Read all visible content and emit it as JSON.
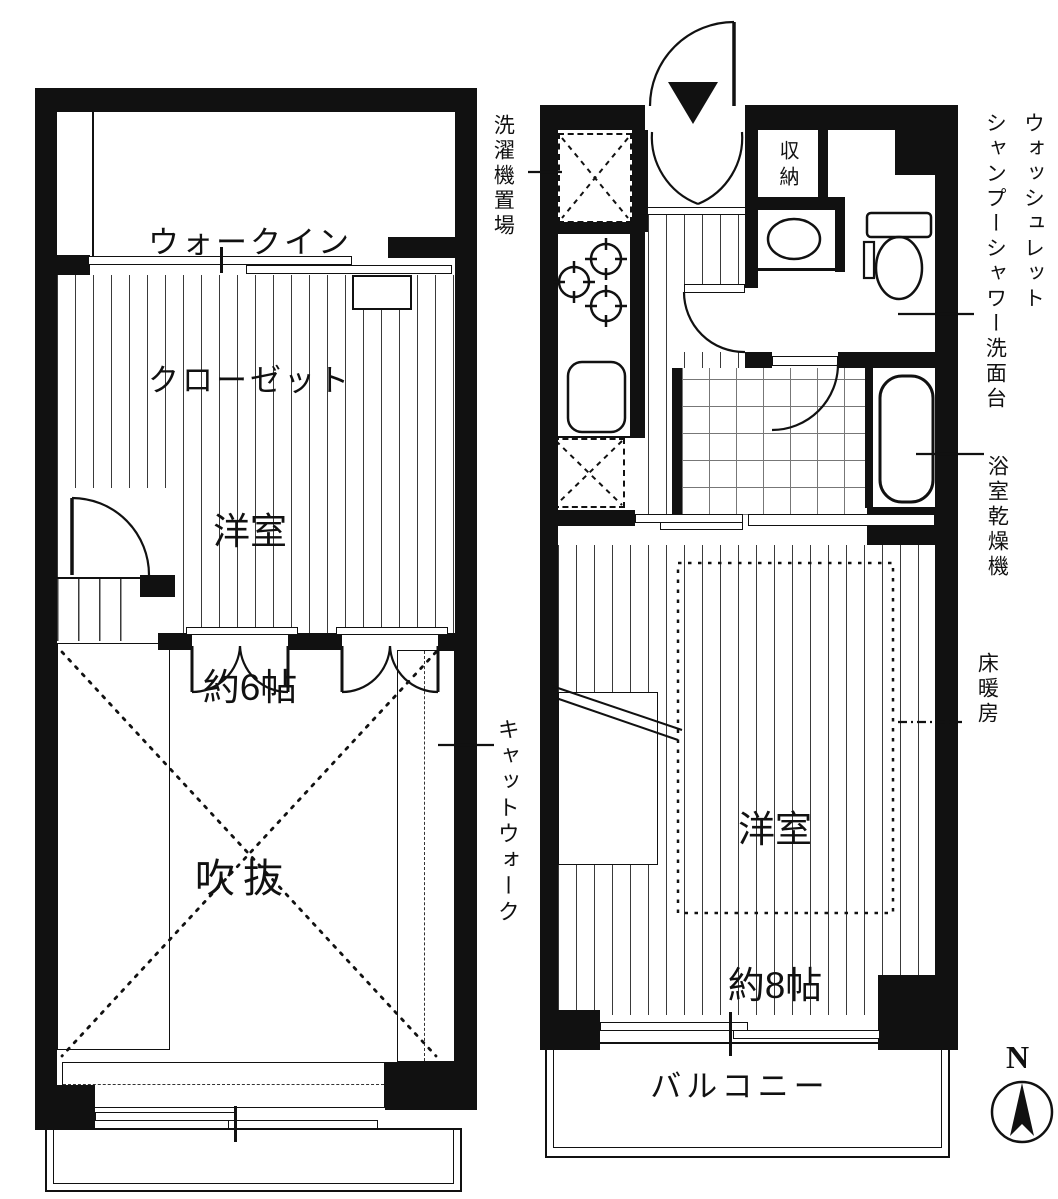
{
  "plans": {
    "left": {
      "walk_in_closet_line1": "ウォークイン",
      "walk_in_closet_line2": "クローゼット",
      "room6_line1": "洋室",
      "room6_line2": "約6帖",
      "void_label": "吹抜",
      "catwalk_label": "キャットウォーク"
    },
    "right": {
      "laundry_label": "洗濯機置場",
      "storage_label": "収納",
      "washlet_label": "ウォッシュレット",
      "shampoo_basin_label": "シャンプーシャワー洗面台",
      "bath_dryer_label": "浴室乾燥機",
      "floor_heating_label": "床暖房",
      "room8_line1": "洋室",
      "room8_line2": "約8帖",
      "balcony_label": "バルコニー"
    },
    "compass": {
      "north_label": "N"
    },
    "colors": {
      "wall": "#111111",
      "line": "#222222"
    }
  }
}
